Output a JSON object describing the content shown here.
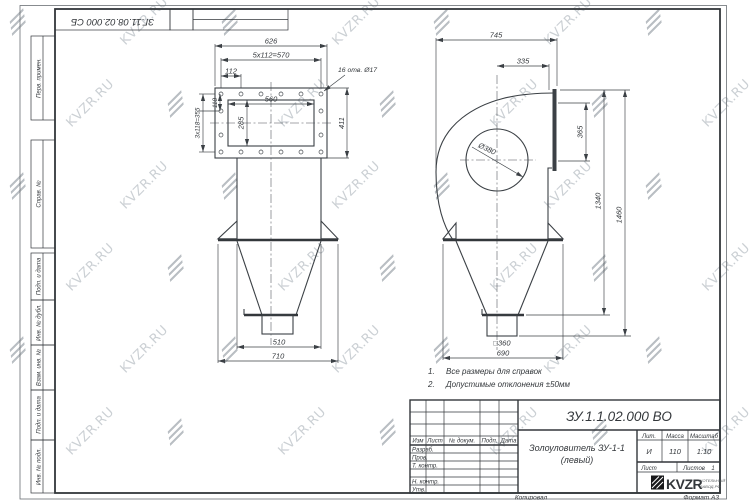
{
  "watermark": {
    "text": "KVZR.RU"
  },
  "frame": {
    "top_doc_number": "ЗГ.11.08.02.000 СБ",
    "left_columns": [
      "Перв. примен.",
      "Справ. №",
      "Подп. и дата",
      "Инв. № дубл.",
      "Взам. инв. №",
      "Подп. и дата",
      "Инв. № подл."
    ]
  },
  "notes": {
    "items": [
      {
        "num": "1.",
        "text": "Все размеры для справок"
      },
      {
        "num": "2.",
        "text": "Допустимые отклонения ±50мм"
      }
    ]
  },
  "views": {
    "front": {
      "dims": {
        "width_top": "626",
        "bolt_spacing": "5x112=570",
        "bolt_step": "112",
        "holes": "16 отв. Ø17",
        "inner_width": "560",
        "inner_height": "285",
        "flange_height": "411",
        "side_step": "118",
        "side_spacing": "3x118=355",
        "cone_top": "510",
        "cone_base": "710"
      }
    },
    "side": {
      "dims": {
        "overall_width": "745",
        "inlet_offset": "335",
        "circle_dia": "Ø380",
        "inlet_height": "365",
        "height_to_flange": "1340",
        "overall_height": "1460",
        "outlet_square": "□360",
        "base_width": "690"
      }
    }
  },
  "title_block": {
    "designation": "ЗУ.1.1.02.000 ВО",
    "name_line1": "Золоуловитель ЗУ-1-1",
    "name_line2": "(левый)",
    "headers": {
      "izm": "Изм",
      "list": "Лист",
      "n_dokum": "№ докум.",
      "podp": "Подп.",
      "data": "Дата",
      "lit": "Лит.",
      "massa": "Масса",
      "masshtab": "Масштаб",
      "list2": "Лист",
      "listov": "Листов"
    },
    "rows": [
      "Разраб.",
      "Пров.",
      "Т. контр.",
      "Н. контр.",
      "Утв."
    ],
    "values": {
      "lit": "И",
      "massa": "110",
      "masshtab": "1:10",
      "listov": "1"
    },
    "logo": {
      "text": "KVZR",
      "sub1": "КОТЕЛЬНЫЙ",
      "sub2": "ЗАВОД.РФ"
    },
    "footer": {
      "kopiroval": "Копировал",
      "format": "Формат А3"
    }
  }
}
